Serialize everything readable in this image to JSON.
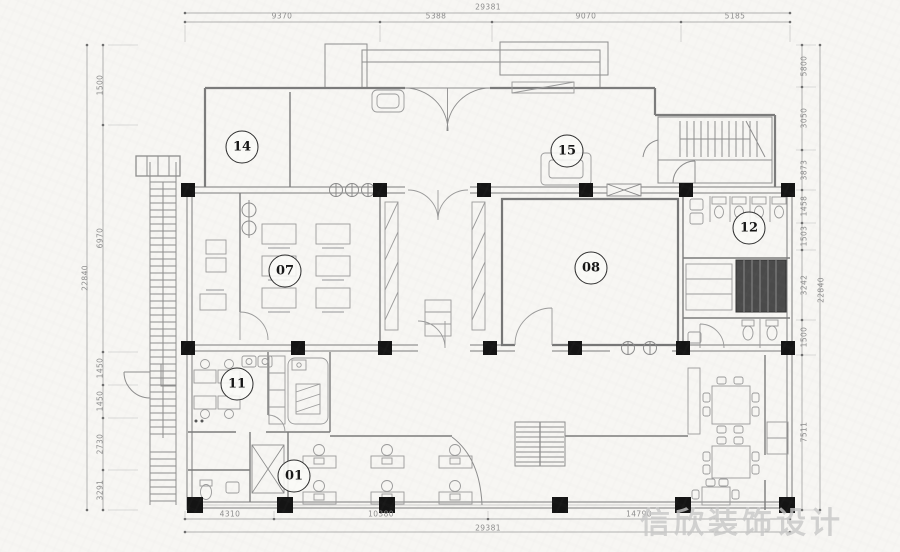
{
  "sheet": {
    "background": "#f7f6f3",
    "line_color": "#7b7b7b",
    "column_color": "#141414",
    "dim_text_color": "#8d8d8d"
  },
  "watermark": {
    "text": "信欣装饰设计",
    "color": "#c8c8c8"
  },
  "rooms": [
    {
      "label": "14",
      "x": 242,
      "y": 147
    },
    {
      "label": "15",
      "x": 567,
      "y": 151
    },
    {
      "label": "12",
      "x": 749,
      "y": 228
    },
    {
      "label": "07",
      "x": 285,
      "y": 271
    },
    {
      "label": "08",
      "x": 591,
      "y": 268
    },
    {
      "label": "11",
      "x": 237,
      "y": 384
    },
    {
      "label": "01",
      "x": 294,
      "y": 476
    }
  ],
  "dimensions": {
    "top": {
      "total": {
        "label": "29381",
        "x": 488,
        "y": 7
      },
      "segments": [
        {
          "label": "9370",
          "x": 282,
          "y": 16
        },
        {
          "label": "5388",
          "x": 436,
          "y": 16
        },
        {
          "label": "9070",
          "x": 586,
          "y": 16
        },
        {
          "label": "5185",
          "x": 735,
          "y": 16
        }
      ]
    },
    "bottom": {
      "total": {
        "label": "29381",
        "x": 488,
        "y": 528
      },
      "segments": [
        {
          "label": "4310",
          "x": 230,
          "y": 514
        },
        {
          "label": "10380",
          "x": 381,
          "y": 514
        },
        {
          "label": "14790",
          "x": 639,
          "y": 514
        }
      ]
    },
    "left": {
      "total": {
        "label": "22840",
        "x": 85,
        "y": 278
      },
      "segments": [
        {
          "label": "1500",
          "x": 100,
          "y": 85
        },
        {
          "label": "6970",
          "x": 100,
          "y": 238
        },
        {
          "label": "1450",
          "x": 100,
          "y": 368
        },
        {
          "label": "1450",
          "x": 100,
          "y": 401
        },
        {
          "label": "2730",
          "x": 100,
          "y": 444
        },
        {
          "label": "3291",
          "x": 100,
          "y": 490
        }
      ]
    },
    "right": {
      "total": {
        "label": "22840",
        "x": 821,
        "y": 290
      },
      "segments": [
        {
          "label": "5800",
          "x": 804,
          "y": 66
        },
        {
          "label": "3050",
          "x": 804,
          "y": 118
        },
        {
          "label": "3873",
          "x": 804,
          "y": 170
        },
        {
          "label": "1458",
          "x": 804,
          "y": 206
        },
        {
          "label": "1503",
          "x": 804,
          "y": 236
        },
        {
          "label": "3242",
          "x": 804,
          "y": 285
        },
        {
          "label": "1500",
          "x": 804,
          "y": 337
        },
        {
          "label": "7511",
          "x": 804,
          "y": 432
        }
      ]
    }
  }
}
